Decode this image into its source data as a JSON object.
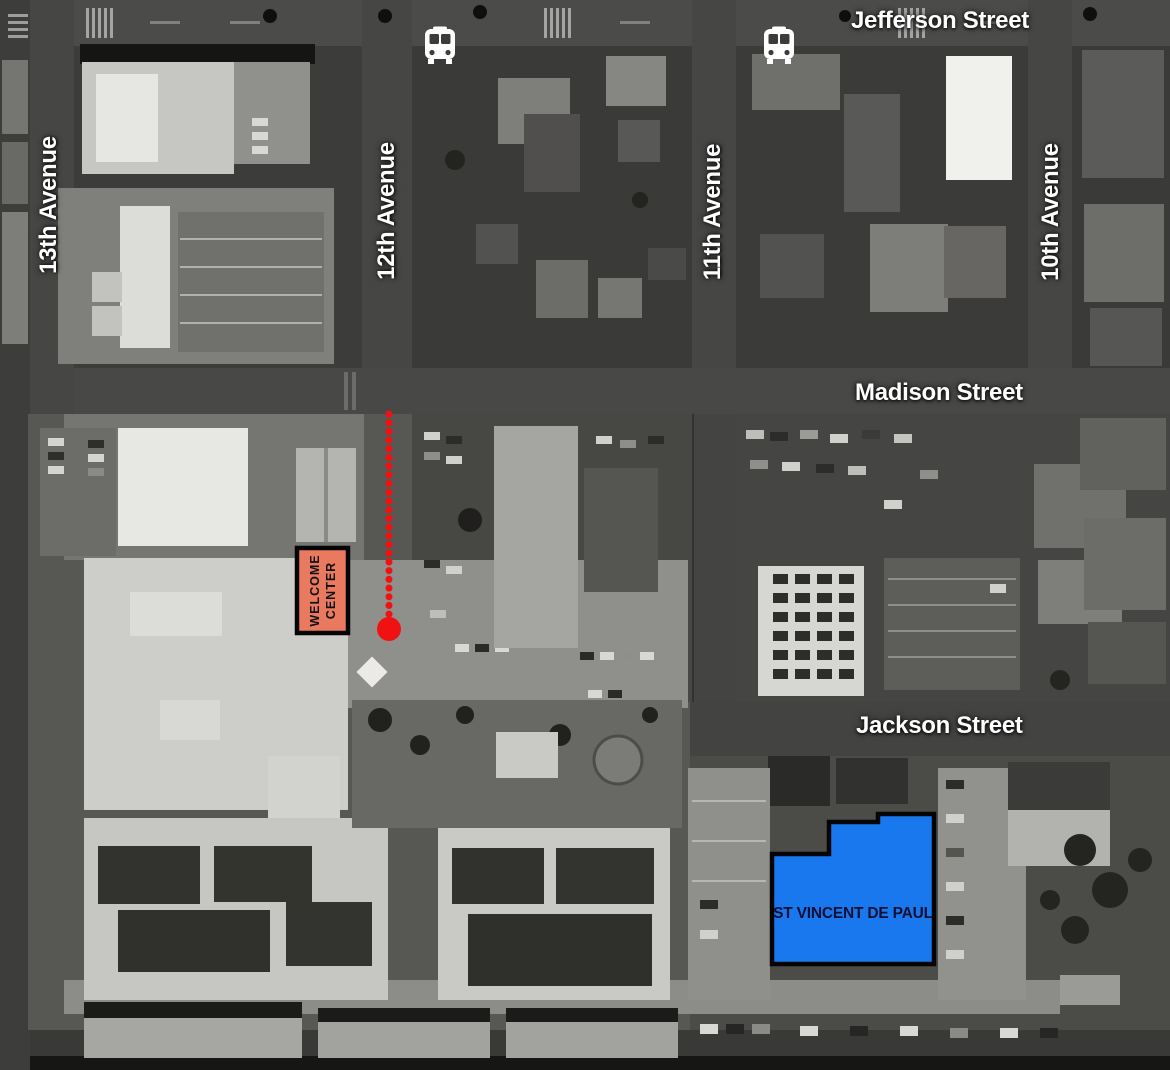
{
  "map": {
    "streets": [
      {
        "id": "jefferson",
        "label": "Jefferson Street"
      },
      {
        "id": "madison",
        "label": "Madison Street"
      },
      {
        "id": "jackson",
        "label": "Jackson Street"
      }
    ],
    "avenues": [
      {
        "id": "13th",
        "label": "13th Avenue"
      },
      {
        "id": "12th",
        "label": "12th Avenue"
      },
      {
        "id": "11th",
        "label": "11th Avenue"
      },
      {
        "id": "10th",
        "label": "10th Avenue"
      }
    ],
    "markers": {
      "welcome_center": {
        "line1": "WELCOME",
        "line2": "CENTER",
        "fill": "#e97a60",
        "border": "#050505",
        "text_color": "#111111"
      },
      "st_vincent": {
        "label": "ST VINCENT DE PAUL",
        "fill": "#1a78ee",
        "border": "#050505",
        "text_color": "#0b1033"
      },
      "route": {
        "style": "dotted",
        "color": "#f01212"
      },
      "bus_stops": [
        {
          "icon": "bus-icon"
        },
        {
          "icon": "bus-icon"
        }
      ]
    },
    "label_color": "#ffffff"
  }
}
